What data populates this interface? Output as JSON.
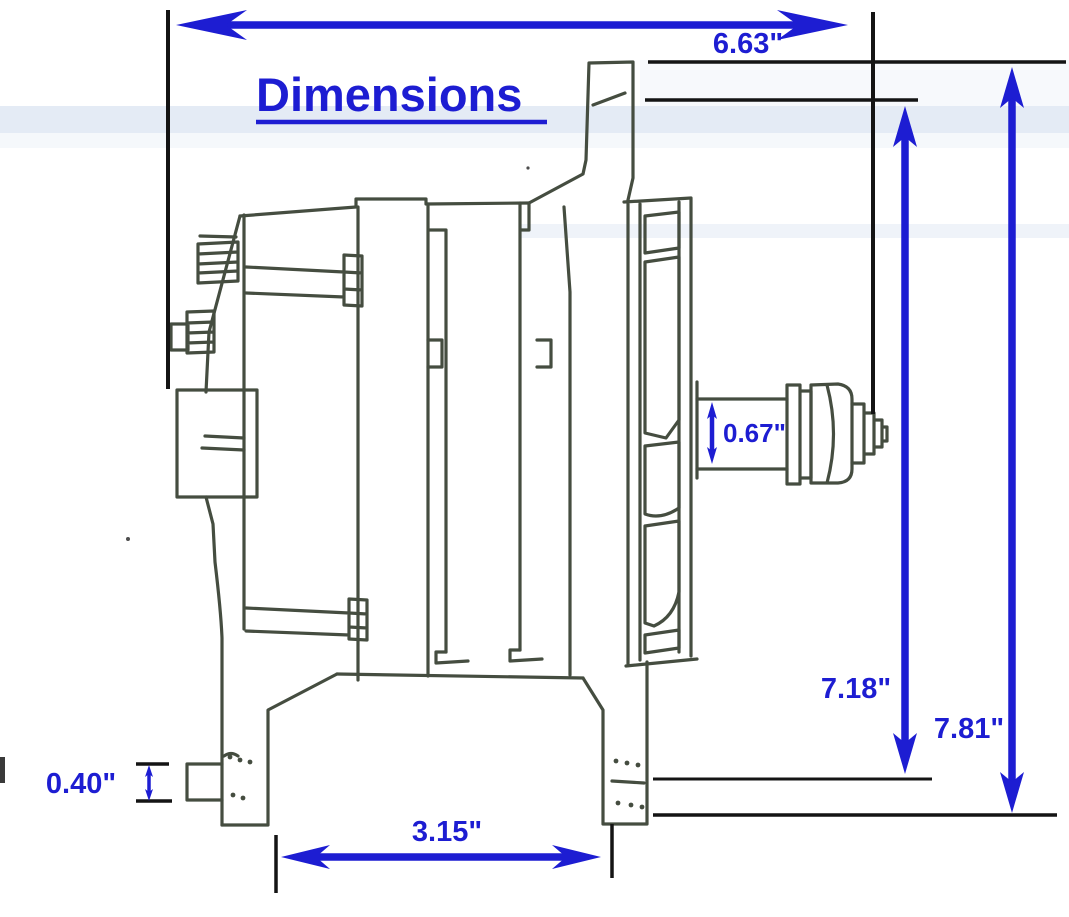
{
  "page": {
    "title": "Dimensions"
  },
  "dimensions": {
    "overall_length": "6.63\"",
    "upper_height": "7.18\"",
    "overall_height": "7.81\"",
    "shaft_shoulder": "0.67\"",
    "foot_tab": "0.40\"",
    "foot_spacing": "3.15\""
  },
  "colors": {
    "annotation_blue": "#1d1dd2",
    "drawing_line": "#454d40",
    "dimension_black": "#141414",
    "paper": "#ffffff"
  }
}
